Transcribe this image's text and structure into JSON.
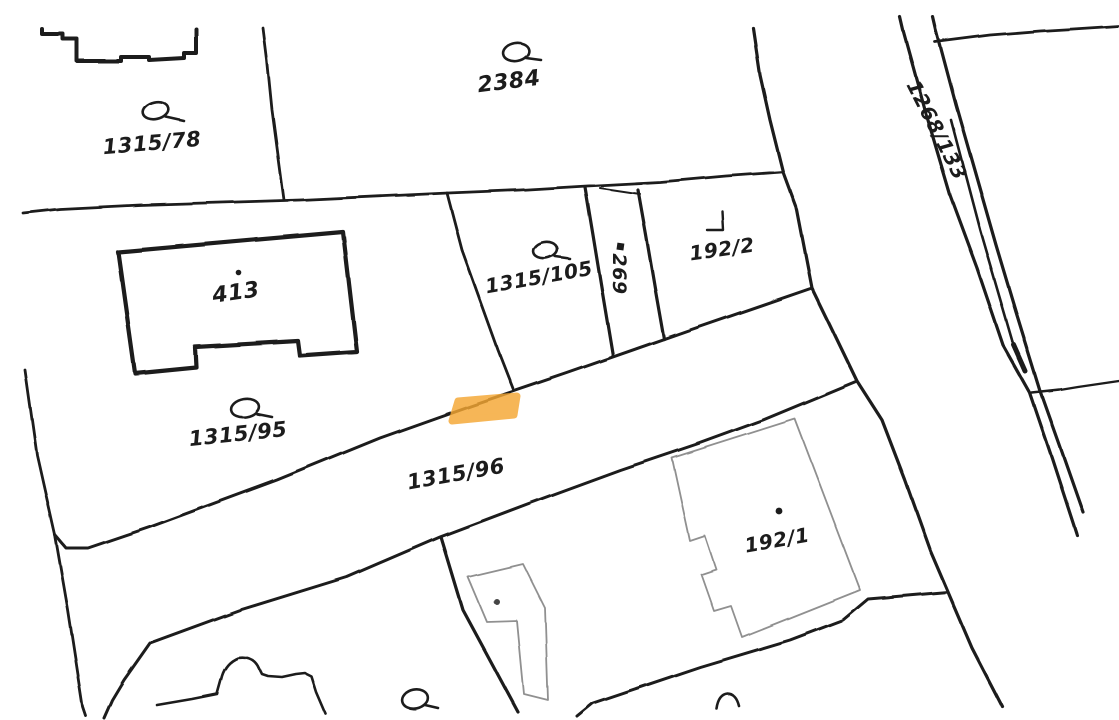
{
  "map": {
    "title": "Cadastral parcel map extract",
    "background_color": "#ffffff",
    "line_color": "#1c1c1c",
    "building_line_color": "#909090",
    "highlight": {
      "name": "selected-road-segment-highlight",
      "color": "#f5a733",
      "opacity": "0.82"
    },
    "labels": [
      {
        "text": "1315/78",
        "x": 152,
        "y": 143,
        "rotation": -5,
        "size": 21
      },
      {
        "text": "2384",
        "x": 509,
        "y": 82,
        "rotation": -7,
        "size": 22
      },
      {
        "text": "413",
        "x": 236,
        "y": 293,
        "rotation": -8,
        "size": 22
      },
      {
        "text": "1315/105",
        "x": 539,
        "y": 277,
        "rotation": -10,
        "size": 20
      },
      {
        "text": "269",
        "x": 619,
        "y": 274,
        "rotation": 90,
        "size": 19
      },
      {
        "text": "192/2",
        "x": 722,
        "y": 249,
        "rotation": -8,
        "size": 20
      },
      {
        "text": "1315/95",
        "x": 238,
        "y": 434,
        "rotation": -6,
        "size": 21
      },
      {
        "text": "1315/96",
        "x": 456,
        "y": 474,
        "rotation": -10,
        "size": 21
      },
      {
        "text": "192/1",
        "x": 777,
        "y": 540,
        "rotation": -10,
        "size": 20
      },
      {
        "text": "1268/133",
        "x": 937,
        "y": 130,
        "rotation": 63,
        "size": 20
      }
    ],
    "icons": {
      "grassland_symbol": "ellipse-with-tail",
      "building_point": "filled-dot",
      "house_number_marker": "filled-square",
      "corner_mark": "right-angle"
    }
  }
}
